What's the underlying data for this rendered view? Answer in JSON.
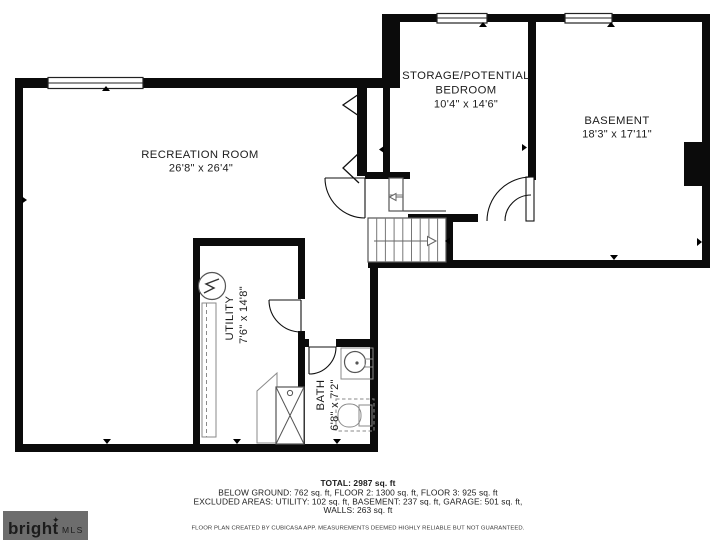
{
  "plan": {
    "rooms": {
      "recreation": {
        "name": "RECREATION ROOM",
        "dims": "26'8\" x 26'4\""
      },
      "storage": {
        "name_line1": "STORAGE/POTENTIAL",
        "name_line2": "BEDROOM",
        "dims": "10'4\" x 14'6\""
      },
      "basement": {
        "name": "BASEMENT",
        "dims": "18'3\" x 17'11\""
      },
      "utility": {
        "name": "UTILITY",
        "dims": "7'6\" x 14'8\""
      },
      "bath": {
        "name": "BATH",
        "dims": "6'8\" x 7'2\""
      }
    }
  },
  "summary": {
    "total": "TOTAL: 2987 sq. ft",
    "below_ground": "BELOW GROUND: 762 sq. ft, FLOOR 2: 1300 sq. ft, FLOOR 3: 925 sq. ft",
    "excluded": "EXCLUDED AREAS: UTILITY: 102 sq. ft, BASEMENT: 237 sq. ft, GARAGE: 501 sq. ft,",
    "walls": "WALLS: 263 sq. ft"
  },
  "disclaimer": "FLOOR PLAN CREATED BY CUBICASA APP. MEASUREMENTS DEEMED HIGHLY RELIABLE BUT NOT GUARANTEED.",
  "logo": {
    "brand": "bright",
    "accent_mark": "✦",
    "suffix": "MLS",
    "bg_color": "#6d6d6d",
    "accent_color": "#bf5f3b",
    "text_color": "#ffffff"
  }
}
